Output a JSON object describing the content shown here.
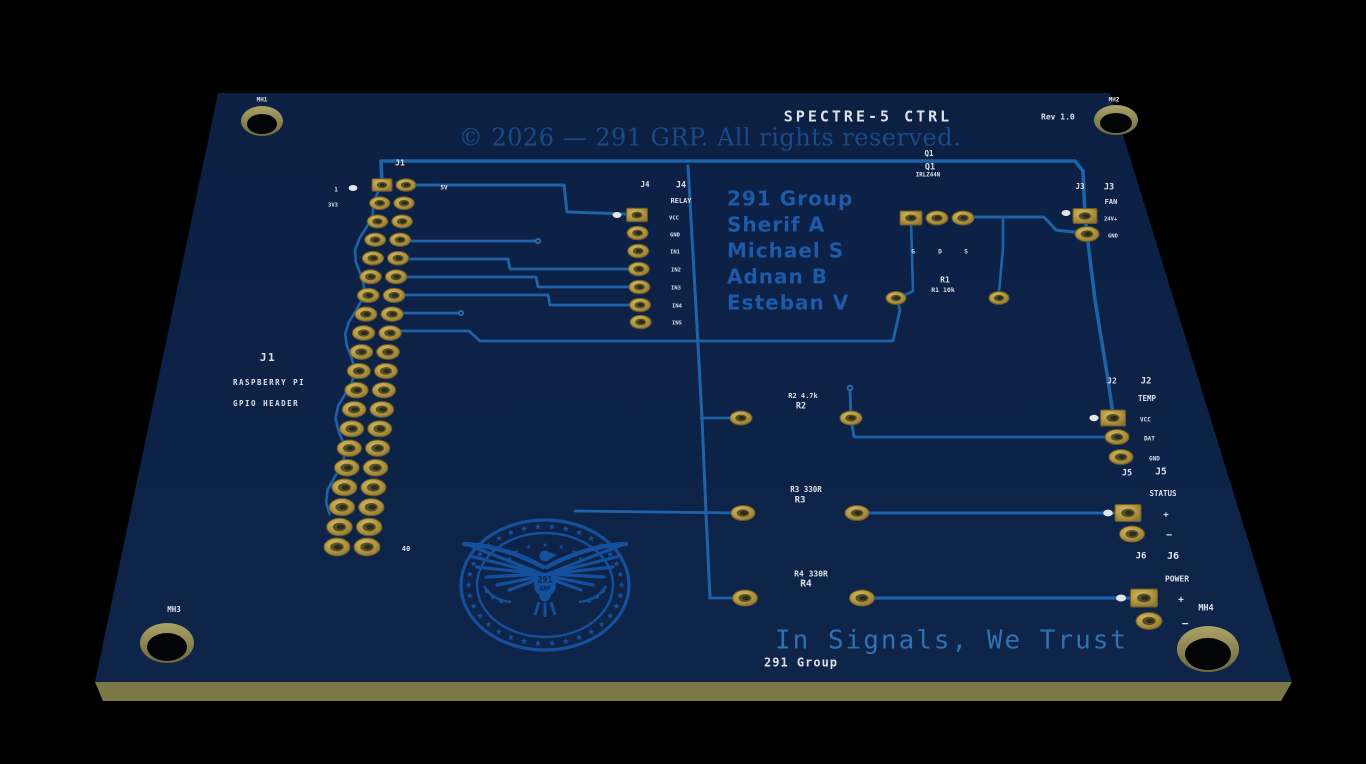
{
  "palette": {
    "background": "#000000",
    "board": "#0d2348",
    "board_edge": "#7c7948",
    "trace": "#1e63a8",
    "silkscreen": "#dce0e8",
    "copper_text": "#1d5aa8",
    "copyright_text": "#1c4a88",
    "motto_text": "#2e72b4",
    "logo_blue": "#15509c",
    "pad_gold": "#b59a42"
  },
  "title_block": {
    "title": "SPECTRE-5 CTRL",
    "revision": "Rev 1.0",
    "copyright": "© 2026 — 291 GRP. All rights reserved."
  },
  "credits": {
    "line1": "291 Group",
    "line2": "Sherif A",
    "line3": "Michael S",
    "line4": "Adnan B",
    "line5": "Esteban V"
  },
  "motto": "In Signals, We Trust",
  "brand": "291 Group",
  "logo": {
    "top": "291",
    "bottom": "GRP"
  },
  "connectors": {
    "j1": {
      "ref": "J1",
      "desc1": "RASPBERRY PI",
      "desc2": "GPIO HEADER",
      "pin_first": "1",
      "pin_first_net": "3V3",
      "pin_last": "40",
      "net_5v": "5V",
      "pin_count": 40
    },
    "j4": {
      "ref": "J4",
      "name": "RELAY",
      "pins": [
        "VCC",
        "GND",
        "IN1",
        "IN2",
        "IN3",
        "IN4",
        "IN5"
      ]
    },
    "j3": {
      "ref": "J3",
      "name": "FAN",
      "pins": [
        "24V+",
        "GND"
      ]
    },
    "j2": {
      "ref": "J2",
      "name": "TEMP",
      "pins": [
        "VCC",
        "DAT",
        "GND"
      ]
    },
    "j5": {
      "ref": "J5",
      "name": "STATUS",
      "pins": [
        "+",
        "−"
      ]
    },
    "j6": {
      "ref": "J6",
      "name": "POWER",
      "pins": [
        "+",
        "−"
      ]
    }
  },
  "components": {
    "q1": {
      "ref": "Q1",
      "value": "IRLZ44N",
      "pin_g": "G",
      "pin_d": "D",
      "pin_s": "S"
    },
    "r1": {
      "ref": "R1",
      "value": "R1 10k"
    },
    "r2": {
      "ref": "R2",
      "value": "R2 4.7k"
    },
    "r3": {
      "ref": "R3",
      "value": "R3 330R"
    },
    "r4": {
      "ref": "R4",
      "value": "R4 330R"
    }
  },
  "mounting_holes": {
    "mh1": "MH1",
    "mh2": "MH2",
    "mh3": "MH3",
    "mh4": "MH4"
  }
}
